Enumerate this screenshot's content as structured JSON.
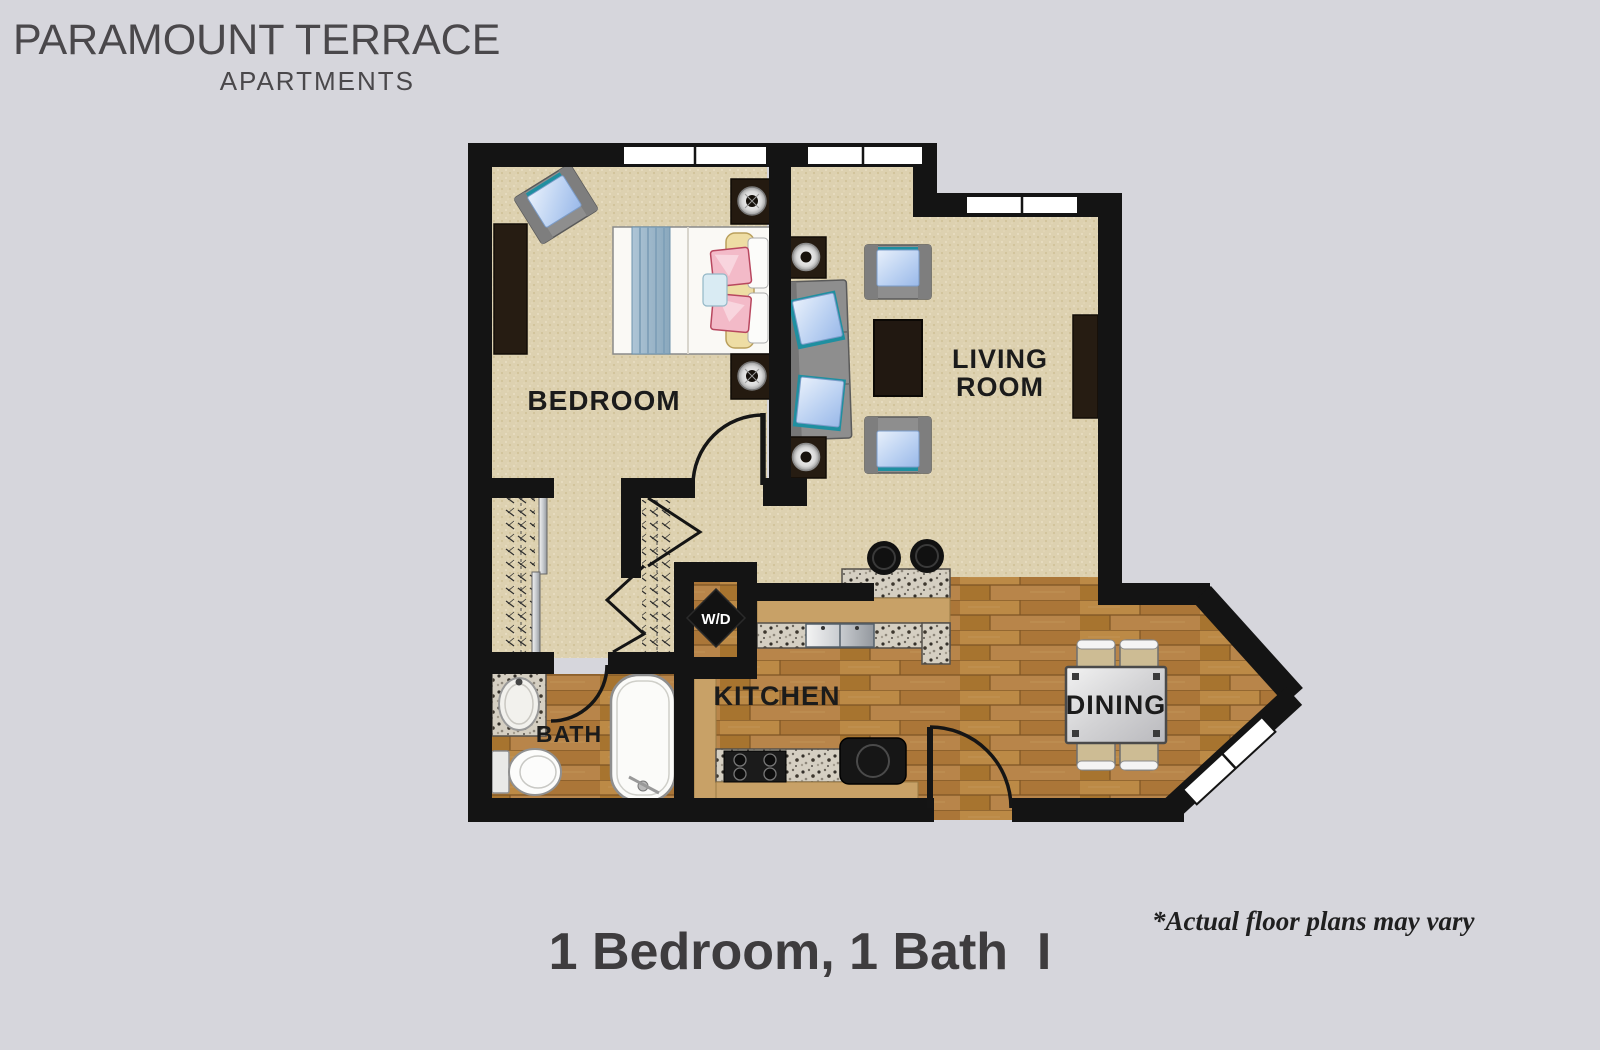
{
  "logo": {
    "name": "PARAMOUNT TERRACE",
    "subtitle": "APARTMENTS"
  },
  "plan": {
    "labels": {
      "bedroom": "BEDROOM",
      "living1": "LIVING",
      "living2": "ROOM",
      "kitchen": "KITCHEN",
      "dining": "DINING",
      "bath": "BATH",
      "wd": "W/D"
    },
    "colors": {
      "background": "#d6d6dc",
      "wall": "#141414",
      "carpet": "#ddd1b0",
      "wood": "#b17c3e",
      "counter_tan": "#c8a167",
      "granite": "#d5cfc2",
      "accent_teal": "#1f8fa0",
      "pillow_blue": "#aec9ef",
      "pillow_pink": "#f3bac8",
      "headboard_yellow": "#eedda4",
      "furniture_gray": "#8e8e8e",
      "furniture_dark": "#261c12"
    }
  },
  "caption": {
    "title": "1 Bedroom, 1 Bath  I",
    "disclaimer": "*Actual floor plans may vary"
  }
}
